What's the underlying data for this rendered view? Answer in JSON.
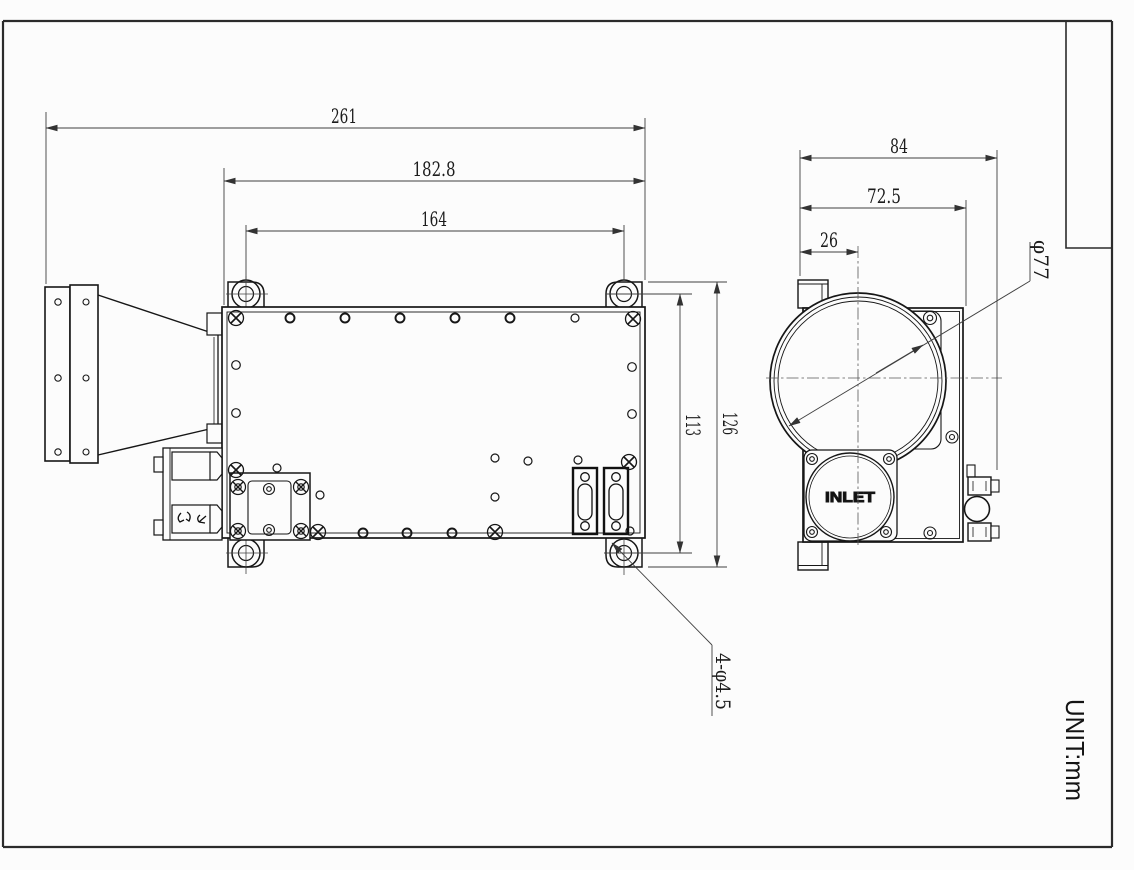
{
  "sheet": {
    "unit_label": "UNIT:mm"
  },
  "front_view": {
    "label": "front view",
    "dims": {
      "overall_width": "261",
      "flange_width": "182.8",
      "hole_spacing_h": "164",
      "hole_spacing_v": "113",
      "overall_height": "126"
    },
    "callouts": {
      "mount_holes": "4-φ4.5"
    }
  },
  "side_view": {
    "label": "side view",
    "dims": {
      "overall_depth": "84",
      "body_depth": "72.5",
      "lens_center_offset": "26"
    },
    "callouts": {
      "lens_diameter": "φ77"
    },
    "inlet_label": "INLET"
  }
}
